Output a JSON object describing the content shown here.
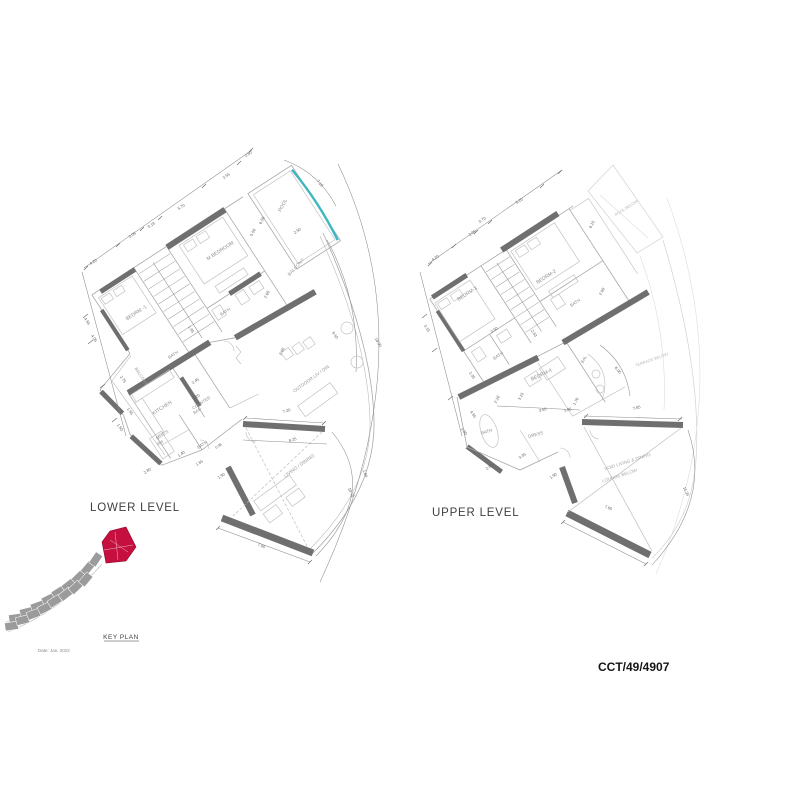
{
  "drawing": {
    "lower_title": "LOWER LEVEL",
    "upper_title": "UPPER LEVEL",
    "key_plan_label": "KEY PLAN",
    "date_label": "Date: Jan. 2022",
    "drawing_number": "CCT/49/4907"
  },
  "colors": {
    "pool_edge": "#3db7c2",
    "key_plan_highlight": "#c50f3f",
    "wall": "#6f6f6f",
    "room_label": "#8f8f8f",
    "dim_label": "#5f5f5f"
  },
  "lower_level": {
    "rooms": [
      "M BEDROOM",
      "BEDRM -1",
      "BATH",
      "BATH",
      "BATH",
      "KITCHEN",
      "COUNTER BAR",
      "MAID'S RM",
      "POOL",
      "BALCONY",
      "BALCONY",
      "OUTDOOR LIV / DIN",
      "LIVING / DINING"
    ],
    "dimensions": [
      "4.20",
      "2.05",
      "0.18",
      "5.70",
      "2.55",
      "2.60",
      "7.18",
      "6.50",
      "5.50",
      "2.50",
      "2.65",
      "9.50",
      "18.90",
      "4.55",
      "4.05",
      "1.95",
      "2.75",
      "1.55",
      "1.50",
      "3.20",
      "2.45",
      "2.80",
      "1.40",
      "1.65",
      "1.90",
      "2.05",
      "7.20",
      "8.25",
      "7.60",
      "1.04",
      "10.75",
      "0.98"
    ]
  },
  "upper_level": {
    "rooms": [
      "BEDRM-2",
      "BEDRM-3",
      "BATH",
      "BATH",
      "BATH",
      "BAL",
      "BEDRM-4",
      "DRESS",
      "POOL BELOW",
      "TERRACE BELOW",
      "VOID LIVING & DINING",
      "LOUNGE BELOW"
    ],
    "dimensions": [
      "5.20",
      "0.70",
      "2.05",
      "4.20",
      "6.15",
      "2.60",
      "3.15",
      "3.60",
      "2.63",
      "1.70",
      "6.05",
      "2.35",
      "2.18",
      "3.15",
      "3.65",
      "1.85",
      "7.85",
      "4.55",
      "1.50",
      "2.80",
      "3.35",
      "1.90",
      "7.65",
      "11.35"
    ]
  },
  "annotations": {
    "lower": [
      {
        "t": "M BEDROOM",
        "x": 221,
        "y": 252,
        "r": -33,
        "s": 5,
        "c": "#8f8f8f",
        "n": "room-label"
      },
      {
        "t": "BEDRM -1",
        "x": 137,
        "y": 314,
        "r": -33,
        "s": 5,
        "c": "#8f8f8f",
        "n": "room-label"
      },
      {
        "t": "BATH",
        "x": 226,
        "y": 313,
        "r": -33,
        "s": 4.4,
        "c": "#8f8f8f",
        "n": "room-label"
      },
      {
        "t": "BATH",
        "x": 174,
        "y": 356,
        "r": -33,
        "s": 4.4,
        "c": "#8f8f8f",
        "n": "room-label"
      },
      {
        "t": "BATH",
        "x": 203,
        "y": 446,
        "r": -33,
        "s": 4.4,
        "c": "#8f8f8f",
        "n": "room-label"
      },
      {
        "t": "KITCHEN",
        "x": 163,
        "y": 409,
        "r": -33,
        "s": 5,
        "c": "#8f8f8f",
        "n": "room-label"
      },
      {
        "t": "COUNTER",
        "x": 202,
        "y": 404,
        "r": -33,
        "s": 4.2,
        "c": "#8f8f8f",
        "n": "room-label"
      },
      {
        "t": "BAR",
        "x": 198,
        "y": 412,
        "r": -33,
        "s": 4.2,
        "c": "#8f8f8f",
        "n": "room-label"
      },
      {
        "t": "MAID'S",
        "x": 163,
        "y": 436,
        "r": -33,
        "s": 4.2,
        "c": "#8f8f8f",
        "n": "room-label"
      },
      {
        "t": "RM",
        "x": 161,
        "y": 444,
        "r": -33,
        "s": 4.2,
        "c": "#8f8f8f",
        "n": "room-label"
      },
      {
        "t": "POOL",
        "x": 284,
        "y": 206,
        "r": -62,
        "s": 5,
        "c": "#8f8f8f",
        "n": "room-label"
      },
      {
        "t": "BALCONY",
        "x": 297,
        "y": 268,
        "r": -48,
        "s": 4.6,
        "c": "#9a9a9a",
        "n": "room-label"
      },
      {
        "t": "BALCONY",
        "x": 140,
        "y": 377,
        "r": 57,
        "s": 4.2,
        "c": "#9a9a9a",
        "n": "room-label"
      },
      {
        "t": "OUTDOOR LIV / DIN",
        "x": 312,
        "y": 380,
        "r": -36,
        "s": 4.6,
        "c": "#9a9a9a",
        "n": "room-label"
      },
      {
        "t": "LIVING / DINING",
        "x": 300,
        "y": 467,
        "r": -36,
        "s": 4.8,
        "c": "#9a9a9a",
        "n": "room-label"
      },
      {
        "t": "4.20",
        "x": 94,
        "y": 263,
        "r": -33
      },
      {
        "t": "2.05",
        "x": 133,
        "y": 236,
        "r": -33
      },
      {
        "t": "0.18",
        "x": 152,
        "y": 226,
        "r": -33
      },
      {
        "t": "5.70",
        "x": 182,
        "y": 208,
        "r": -33
      },
      {
        "t": "2.55",
        "x": 227,
        "y": 177,
        "r": -33
      },
      {
        "t": "2.60",
        "x": 249,
        "y": 155,
        "r": -33
      },
      {
        "t": "7.18",
        "x": 319,
        "y": 184,
        "r": 50
      },
      {
        "t": "6.50",
        "x": 263,
        "y": 221,
        "r": -62
      },
      {
        "t": "5.50",
        "x": 254,
        "y": 233,
        "r": -62
      },
      {
        "t": "2.50",
        "x": 298,
        "y": 232,
        "r": -33
      },
      {
        "t": "2.65",
        "x": 268,
        "y": 295,
        "r": -62
      },
      {
        "t": "9.50",
        "x": 334,
        "y": 336,
        "r": 55
      },
      {
        "t": "18.90",
        "x": 377,
        "y": 343,
        "r": 60
      },
      {
        "t": "4.55",
        "x": 86,
        "y": 322,
        "r": 57
      },
      {
        "t": "4.05",
        "x": 93,
        "y": 339,
        "r": 57
      },
      {
        "t": "1.95",
        "x": 190,
        "y": 330,
        "r": 57
      },
      {
        "t": "2.75",
        "x": 122,
        "y": 380,
        "r": 57
      },
      {
        "t": "1.55",
        "x": 129,
        "y": 412,
        "r": 57
      },
      {
        "t": "1.50",
        "x": 119,
        "y": 428,
        "r": 57
      },
      {
        "t": "3.20",
        "x": 197,
        "y": 398,
        "r": -33
      },
      {
        "t": "2.45",
        "x": 196,
        "y": 382,
        "r": -33
      },
      {
        "t": "2.80",
        "x": 148,
        "y": 472,
        "r": -33
      },
      {
        "t": "1.40",
        "x": 182,
        "y": 455,
        "r": -33
      },
      {
        "t": "1.65",
        "x": 200,
        "y": 464,
        "r": -33
      },
      {
        "t": "1.90",
        "x": 222,
        "y": 477,
        "r": -33
      },
      {
        "t": "2.05",
        "x": 283,
        "y": 352,
        "r": -62
      },
      {
        "t": "7.20",
        "x": 287,
        "y": 412,
        "r": -17
      },
      {
        "t": "8.25",
        "x": 293,
        "y": 441,
        "r": -17
      },
      {
        "t": "7.60",
        "x": 261,
        "y": 547,
        "r": 21
      },
      {
        "t": "1.04",
        "x": 364,
        "y": 474,
        "r": 70
      },
      {
        "t": "10.75",
        "x": 350,
        "y": 493,
        "r": 65
      },
      {
        "t": "0.98",
        "x": 219,
        "y": 447,
        "r": -33,
        "s": 3.6
      }
    ],
    "upper": [
      {
        "t": "BEDRM-2",
        "x": 547,
        "y": 278,
        "r": -33,
        "s": 5,
        "c": "#8f8f8f",
        "n": "room-label"
      },
      {
        "t": "BEDRM-3",
        "x": 468,
        "y": 295,
        "r": -33,
        "s": 5,
        "c": "#8f8f8f",
        "n": "room-label"
      },
      {
        "t": "BATH",
        "x": 576,
        "y": 304,
        "r": -33,
        "s": 4.4,
        "c": "#8f8f8f",
        "n": "room-label"
      },
      {
        "t": "BATH",
        "x": 499,
        "y": 357,
        "r": -33,
        "s": 4.4,
        "c": "#8f8f8f",
        "n": "room-label"
      },
      {
        "t": "BATH",
        "x": 487,
        "y": 433,
        "r": -15,
        "s": 4.4,
        "c": "#8f8f8f",
        "n": "room-label"
      },
      {
        "t": "BAL",
        "x": 585,
        "y": 360,
        "r": -62,
        "s": 4.2,
        "c": "#8f8f8f",
        "n": "room-label"
      },
      {
        "t": "BEDRM-4",
        "x": 542,
        "y": 376,
        "r": -25,
        "s": 5,
        "c": "#8f8f8f",
        "n": "room-label"
      },
      {
        "t": "DRESS",
        "x": 536,
        "y": 436,
        "r": -15,
        "s": 4.4,
        "c": "#8f8f8f",
        "n": "room-label"
      },
      {
        "t": "POOL BELOW",
        "x": 627,
        "y": 209,
        "r": -33,
        "s": 4,
        "c": "#b8b8b8",
        "n": "room-label"
      },
      {
        "t": "TERRACE BELOW",
        "x": 652,
        "y": 361,
        "r": -20,
        "s": 4,
        "c": "#b8b8b8",
        "n": "room-label"
      },
      {
        "t": "VOID LIVING & DINING",
        "x": 628,
        "y": 463,
        "r": -18,
        "s": 4.5,
        "c": "#a9a9a9",
        "n": "room-label"
      },
      {
        "t": "LOUNGE BELOW",
        "x": 620,
        "y": 477,
        "r": -18,
        "s": 4.5,
        "c": "#a9a9a9",
        "n": "room-label"
      },
      {
        "t": "5.20",
        "x": 520,
        "y": 202,
        "r": -33
      },
      {
        "t": "0.70",
        "x": 483,
        "y": 221,
        "r": -33
      },
      {
        "t": "2.05",
        "x": 473,
        "y": 234,
        "r": -33
      },
      {
        "t": "4.20",
        "x": 436,
        "y": 259,
        "r": -33
      },
      {
        "t": "6.15",
        "x": 593,
        "y": 225,
        "r": -62
      },
      {
        "t": "2.60",
        "x": 603,
        "y": 292,
        "r": -62
      },
      {
        "t": "3.15",
        "x": 426,
        "y": 329,
        "r": 57
      },
      {
        "t": "3.60",
        "x": 495,
        "y": 331,
        "r": -33
      },
      {
        "t": "2.63",
        "x": 533,
        "y": 334,
        "r": 57
      },
      {
        "t": "1.70",
        "x": 577,
        "y": 402,
        "r": -62
      },
      {
        "t": "6.05",
        "x": 617,
        "y": 371,
        "r": 50
      },
      {
        "t": "2.35",
        "x": 471,
        "y": 376,
        "r": 57
      },
      {
        "t": "2.18",
        "x": 498,
        "y": 400,
        "r": -62
      },
      {
        "t": "3.15",
        "x": 522,
        "y": 397,
        "r": -62
      },
      {
        "t": "3.65",
        "x": 543,
        "y": 411,
        "r": -15
      },
      {
        "t": "1.85",
        "x": 568,
        "y": 411,
        "r": -15
      },
      {
        "t": "7.85",
        "x": 637,
        "y": 409,
        "r": -15
      },
      {
        "t": "4.55",
        "x": 472,
        "y": 415,
        "r": 57
      },
      {
        "t": "1.50",
        "x": 463,
        "y": 432,
        "r": 57
      },
      {
        "t": "2.80",
        "x": 490,
        "y": 468,
        "r": -33
      },
      {
        "t": "3.35",
        "x": 523,
        "y": 457,
        "r": -33
      },
      {
        "t": "1.90",
        "x": 554,
        "y": 477,
        "r": -33
      },
      {
        "t": "7.65",
        "x": 608,
        "y": 509,
        "r": 21
      },
      {
        "t": "11.35",
        "x": 685,
        "y": 492,
        "r": 65
      }
    ]
  }
}
